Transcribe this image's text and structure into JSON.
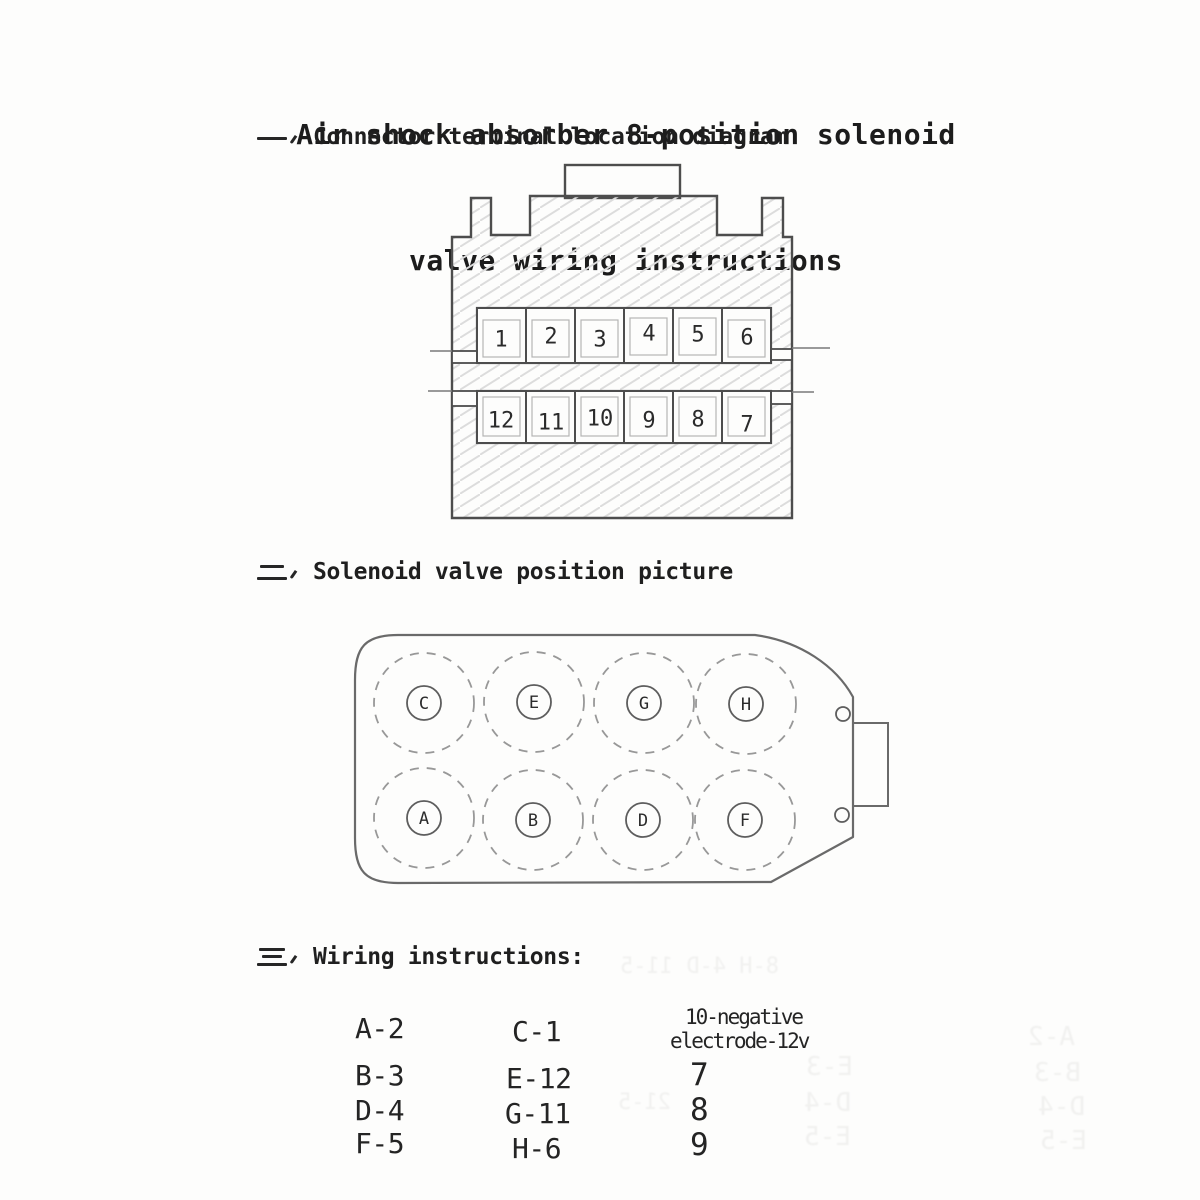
{
  "title": {
    "line1": "Air shock absorber 8-position solenoid",
    "line2": "valve wiring instructions"
  },
  "sections": [
    {
      "index_glyph": "一",
      "label": "Connector terminal location diagram"
    },
    {
      "index_glyph": "二",
      "label": "Solenoid valve position picture"
    },
    {
      "index_glyph": "三",
      "label": "Wiring instructions:"
    }
  ],
  "connector_diagram": {
    "top_row": [
      "1",
      "2",
      "3",
      "4",
      "5",
      "6"
    ],
    "bottom_row": [
      "12",
      "11",
      "10",
      "9",
      "8",
      "7"
    ]
  },
  "solenoid_diagram": {
    "top_row": [
      "C",
      "E",
      "G",
      "H"
    ],
    "bottom_row": [
      "A",
      "B",
      "D",
      "F"
    ]
  },
  "wiring": {
    "pairs_col1": [
      "A-2",
      "B-3",
      "D-4",
      "F-5"
    ],
    "pairs_col2": [
      "C-1",
      "E-12",
      "G-11",
      "H-6"
    ],
    "negative_note_line1": "10-negative",
    "negative_note_line2": "electrode-12v",
    "ground_pins": [
      "7",
      "8",
      "9"
    ]
  },
  "ghost_text": {
    "items": [
      {
        "text": "8-H 4-D 11-5",
        "x": 620,
        "y": 954
      },
      {
        "text": "E-3",
        "x": 806,
        "y": 1052
      },
      {
        "text": "D-4",
        "x": 804,
        "y": 1088
      },
      {
        "text": "E-5",
        "x": 804,
        "y": 1122
      },
      {
        "text": "A-2",
        "x": 1028,
        "y": 1022
      },
      {
        "text": "B-3",
        "x": 1034,
        "y": 1058
      },
      {
        "text": "D-4",
        "x": 1038,
        "y": 1092
      },
      {
        "text": "E-5",
        "x": 1040,
        "y": 1126
      },
      {
        "text": "21-5",
        "x": 618,
        "y": 1090
      }
    ]
  },
  "colors": {
    "ink": "#2b2b2b",
    "outline": "#4d4d4d",
    "hatch": "#dcdcdc",
    "paper": "#fdfdfc"
  }
}
